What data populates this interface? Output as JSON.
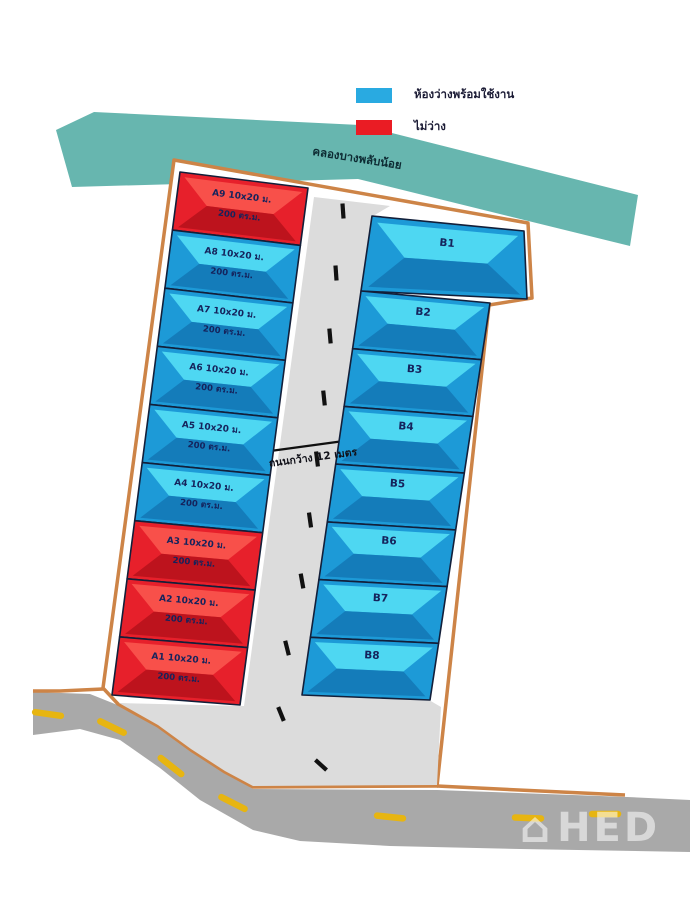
{
  "legend": {
    "items": [
      {
        "label": "ห้องว่างพร้อมใช้งาน",
        "status": "available"
      },
      {
        "label": "ไม่ว่าง",
        "status": "occupied"
      }
    ]
  },
  "canal": {
    "label": "คลองบางพลับน้อย"
  },
  "road": {
    "width_label": "ถนนกว้าง 12 เมตร"
  },
  "units": {
    "a_column": [
      {
        "code": "A9",
        "size": "10x20 ม.",
        "area": "200 ตร.ม.",
        "status": "occupied"
      },
      {
        "code": "A8",
        "size": "10x20 ม.",
        "area": "200 ตร.ม.",
        "status": "available"
      },
      {
        "code": "A7",
        "size": "10x20 ม.",
        "area": "200 ตร.ม.",
        "status": "available"
      },
      {
        "code": "A6",
        "size": "10x20 ม.",
        "area": "200 ตร.ม.",
        "status": "available"
      },
      {
        "code": "A5",
        "size": "10x20 ม.",
        "area": "200 ตร.ม.",
        "status": "available"
      },
      {
        "code": "A4",
        "size": "10x20 ม.",
        "area": "200 ตร.ม.",
        "status": "available"
      },
      {
        "code": "A3",
        "size": "10x20 ม.",
        "area": "200 ตร.ม.",
        "status": "occupied"
      },
      {
        "code": "A2",
        "size": "10x20 ม.",
        "area": "200 ตร.ม.",
        "status": "occupied"
      },
      {
        "code": "A1",
        "size": "10x20 ม.",
        "area": "200 ตร.ม.",
        "status": "occupied"
      }
    ],
    "b_column": [
      {
        "code": "B1",
        "status": "available"
      },
      {
        "code": "B2",
        "status": "available"
      },
      {
        "code": "B3",
        "status": "available"
      },
      {
        "code": "B4",
        "status": "available"
      },
      {
        "code": "B5",
        "status": "available"
      },
      {
        "code": "B6",
        "status": "available"
      },
      {
        "code": "B7",
        "status": "available"
      },
      {
        "code": "B8",
        "status": "available"
      }
    ]
  },
  "watermark": {
    "text": "HED"
  },
  "colors": {
    "available_base": "#1d9ad7",
    "available_light": "#4ed7f2",
    "available_dark": "#1377b5",
    "occupied_base": "#e7202b",
    "occupied_light": "#f8504a",
    "occupied_dark": "#b5121b",
    "legend_available": "#29aae1",
    "legend_occupied": "#ea1c24",
    "unit_border": "#121f3a",
    "unit_text": "#15235c",
    "canal": "#67b6af",
    "boundary": "#cd8447",
    "road_inner": "#dcdcdc",
    "road_outer": "#a9a9a9",
    "dash_black": "#111111",
    "dash_yellow": "#e7b511"
  }
}
